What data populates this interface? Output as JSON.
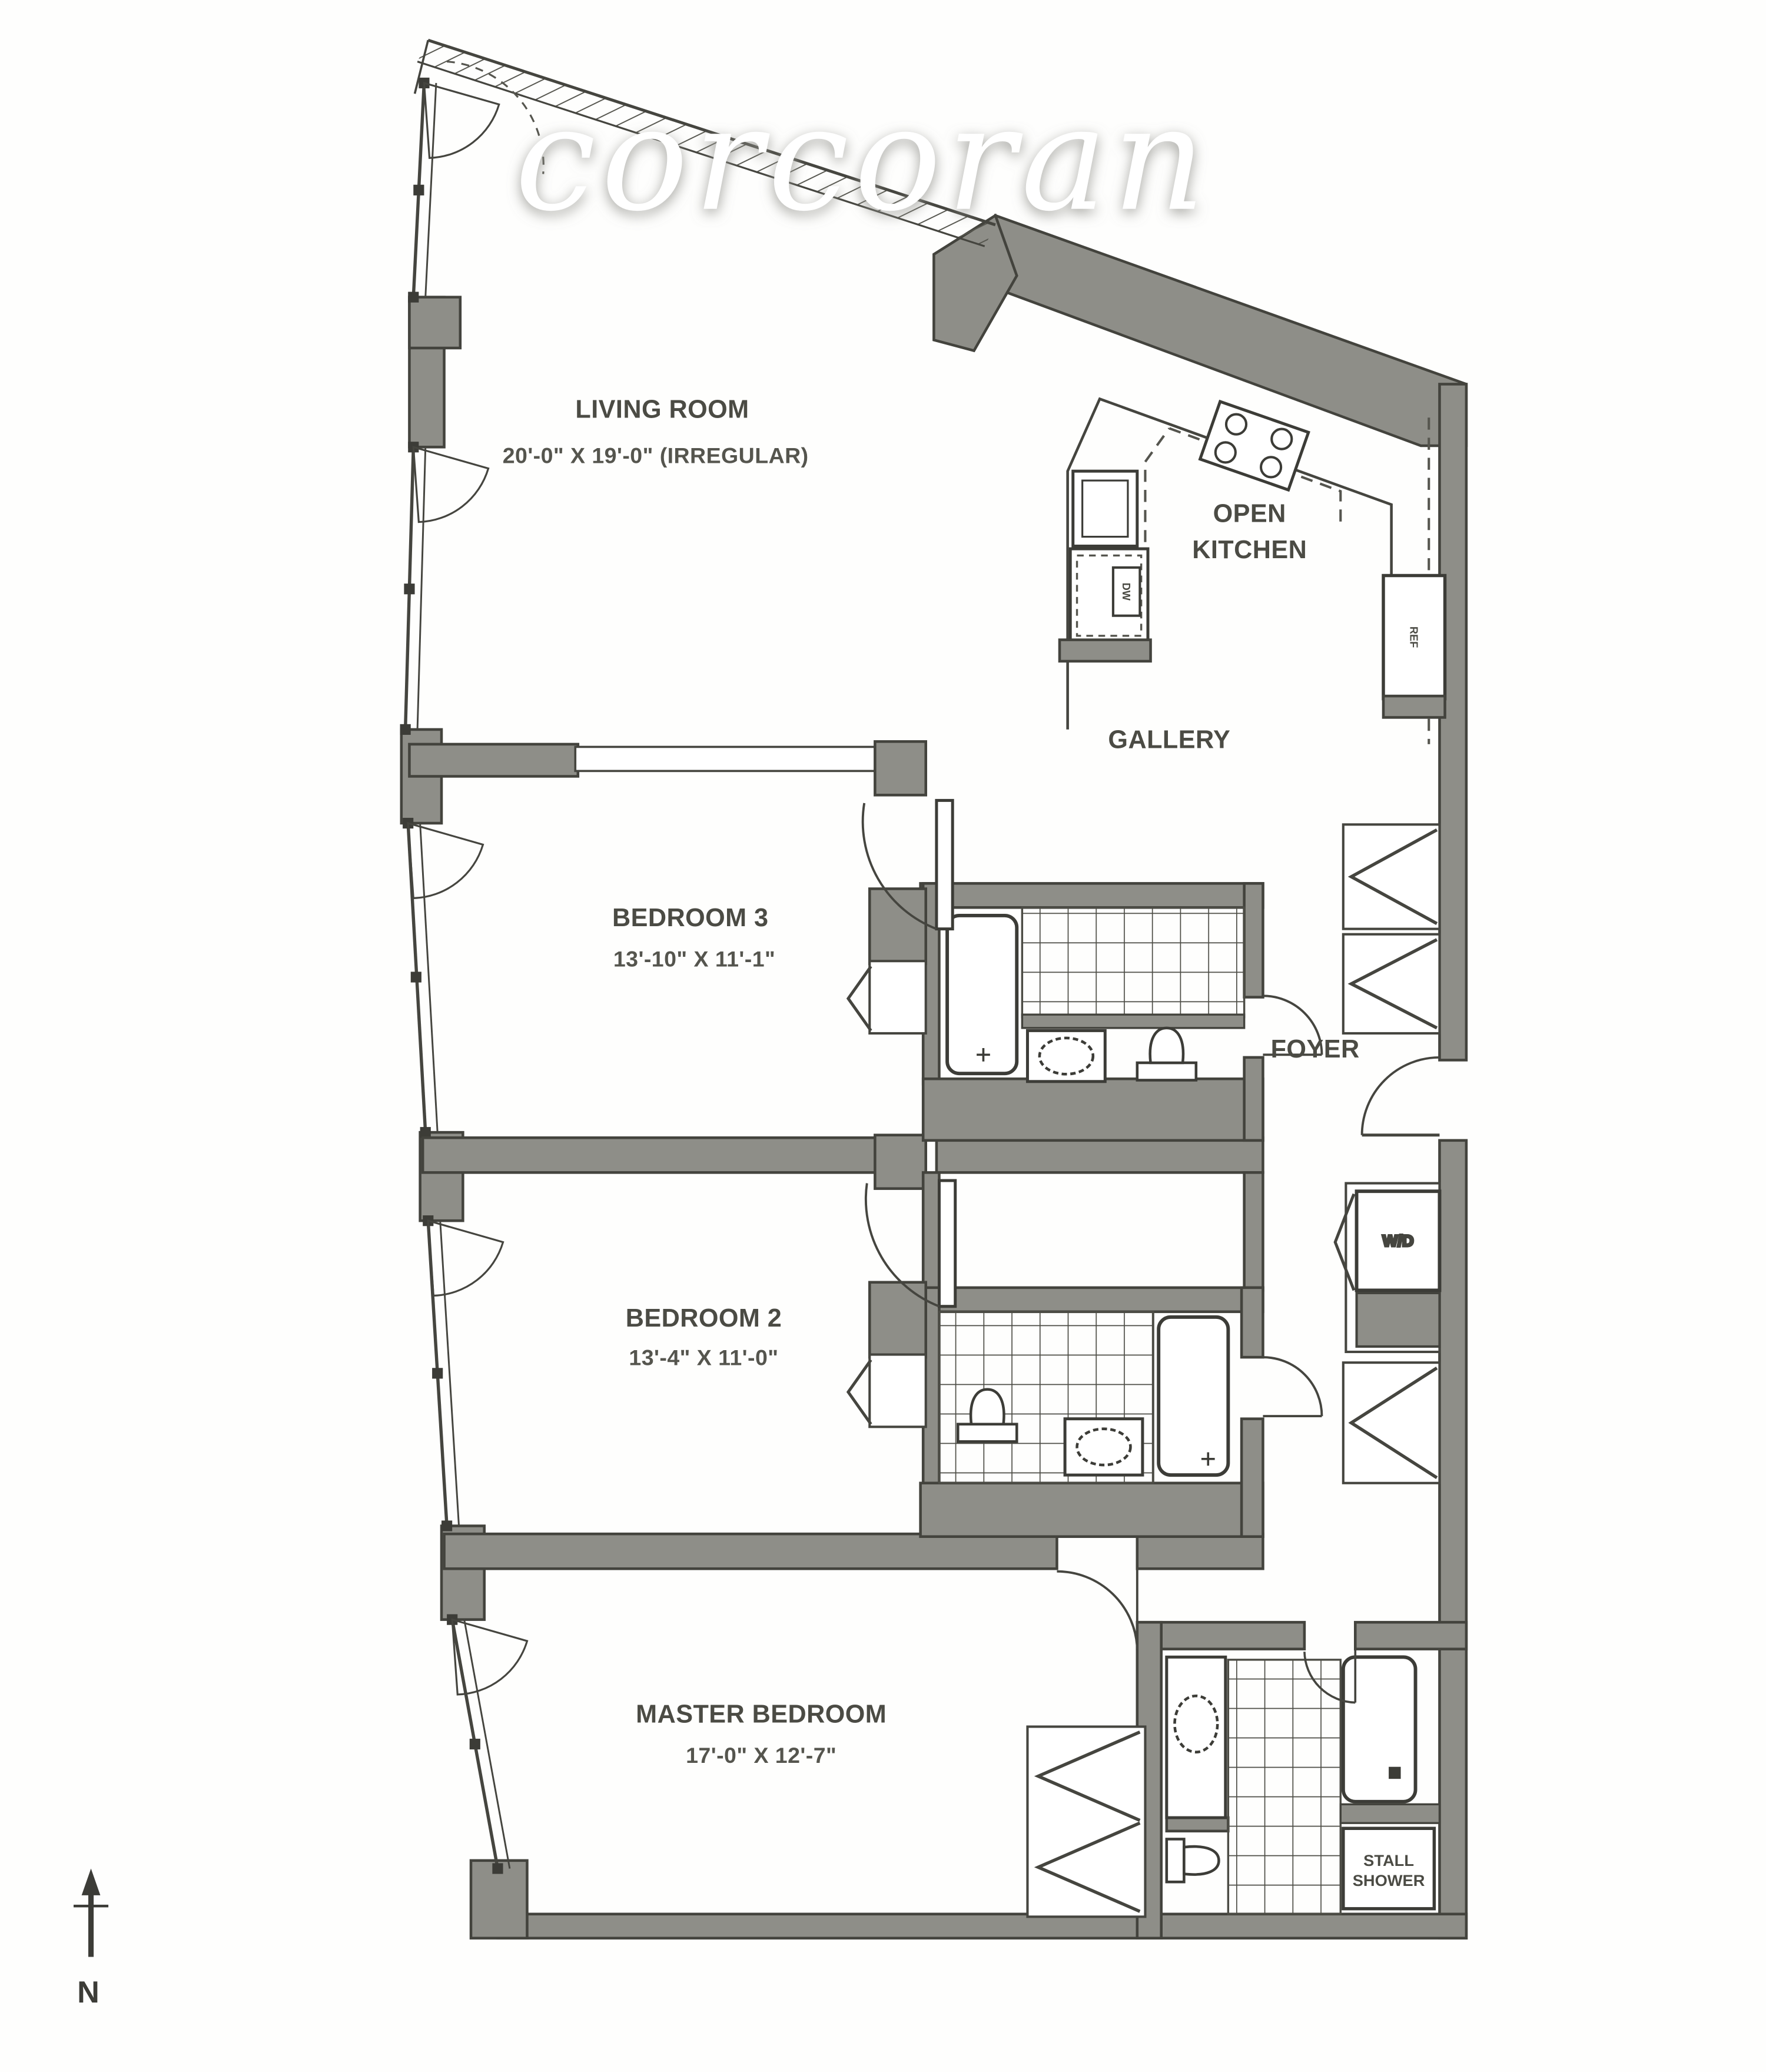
{
  "watermark": {
    "text": "corcoran",
    "color": "#ffffff"
  },
  "palette": {
    "wall_fill": "#8e8e88",
    "wall_stroke": "#43433d",
    "thin_line": "#45453f",
    "label_color": "#4b4b44",
    "background": "#fefefd"
  },
  "rooms": {
    "living_room": {
      "name": "LIVING ROOM",
      "dimensions": "20'-0\"  X  19'-0\" (IRREGULAR)"
    },
    "open_kitchen": {
      "name_line1": "OPEN",
      "name_line2": "KITCHEN"
    },
    "gallery": {
      "name": "GALLERY"
    },
    "bedroom_3": {
      "name": "BEDROOM 3",
      "dimensions": "13'-10\" X 11'-1\""
    },
    "foyer": {
      "name": "FOYER"
    },
    "bedroom_2": {
      "name": "BEDROOM 2",
      "dimensions": "13'-4\" X 11'-0\""
    },
    "master_bedroom": {
      "name": "MASTER BEDROOM",
      "dimensions": "17'-0\" X 12'-7\""
    }
  },
  "fixtures": {
    "washer_dryer": "W/D",
    "stall_shower_line1": "STALL",
    "stall_shower_line2": "SHOWER",
    "refrigerator": "REF",
    "dishwasher": "DW"
  },
  "compass": {
    "north": "N"
  }
}
